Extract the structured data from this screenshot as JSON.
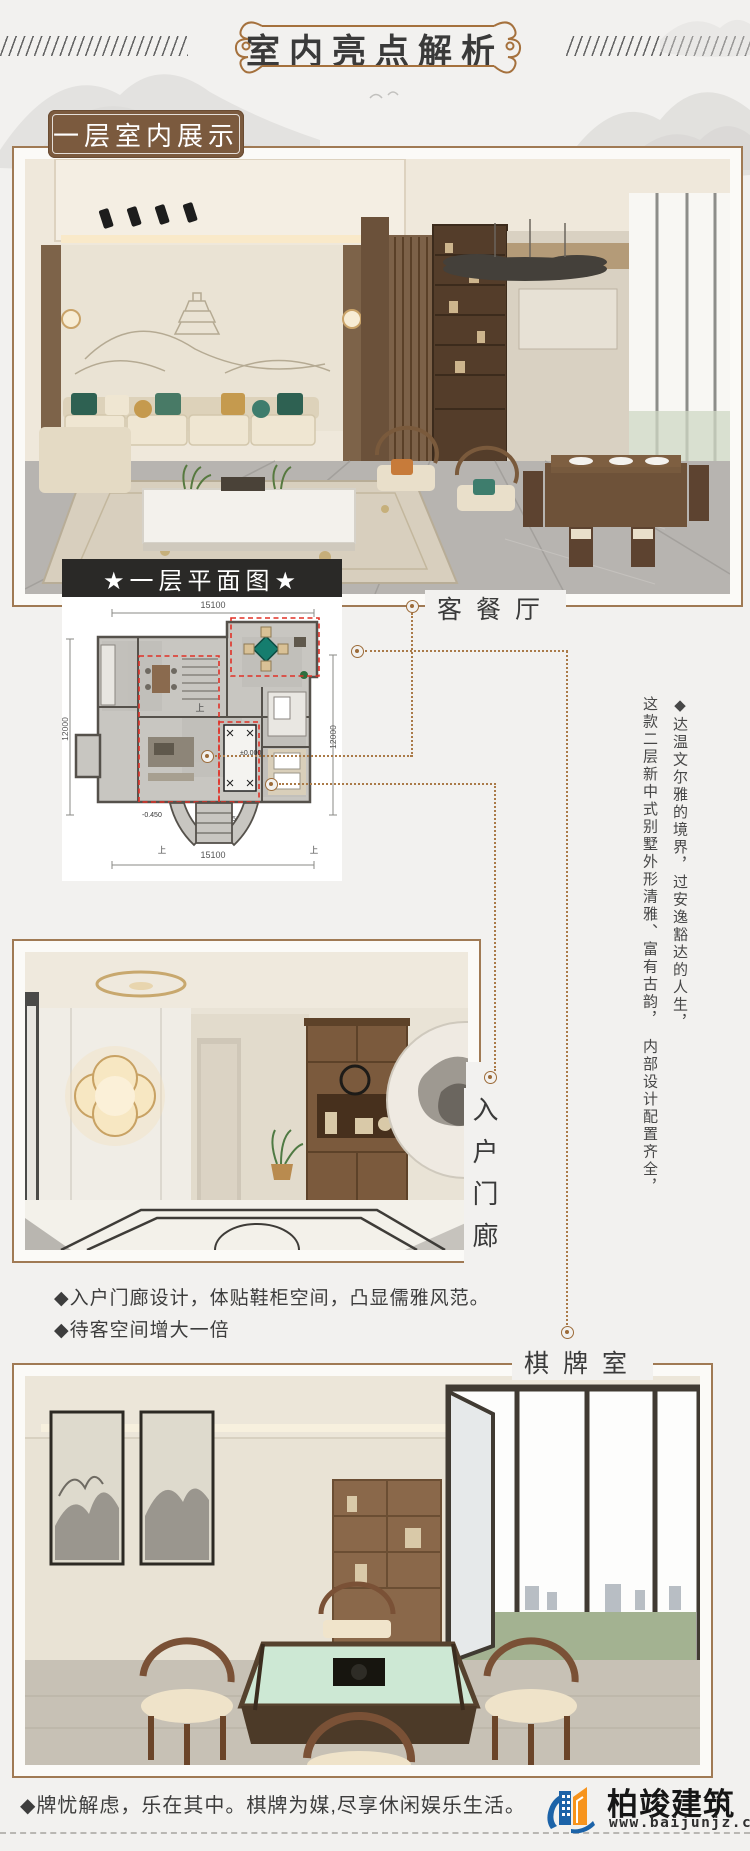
{
  "header": {
    "title": "室内亮点解析"
  },
  "section_label": "一层室内展示",
  "floorplan": {
    "title": "★一层平面图★",
    "dim_top": "15100",
    "dim_bottom": "15100",
    "dim_left": "12000",
    "dim_right": "12000",
    "level_zero": "±0.000",
    "level_left": "-0.450",
    "level_center": "-0.050",
    "stair_up": "上"
  },
  "labels": {
    "living_dining": "客餐厅",
    "entrance": "入户门廊",
    "chess_room": "棋牌室"
  },
  "paragraph": {
    "line1": "◆达温文尔雅的境界，过安逸豁达的人生，",
    "line2": "这款二层新中式别墅外形清雅、富有古韵，　内部设计配置齐全，"
  },
  "bullets": [
    "◆入户门廊设计，体贴鞋柜空间，凸显儒雅风范。",
    "◆待客空间增大一倍"
  ],
  "caption": "◆牌忧解虑，乐在其中。棋牌为媒,尽享休闲娱乐生活。",
  "logo": {
    "name": "柏竣建筑",
    "url": "www.baijunjz.com"
  },
  "colors": {
    "page_bg": "#f2f1ef",
    "accent_brown": "#a07a54",
    "label_bg": "#7b5a3e",
    "bar_bg": "#2a2927",
    "connector": "#aa7a48",
    "plan_highlight_red": "#e03127",
    "text": "#3c3c3c",
    "logo_blue": "#1c63a8",
    "logo_orange": "#f7941d"
  }
}
